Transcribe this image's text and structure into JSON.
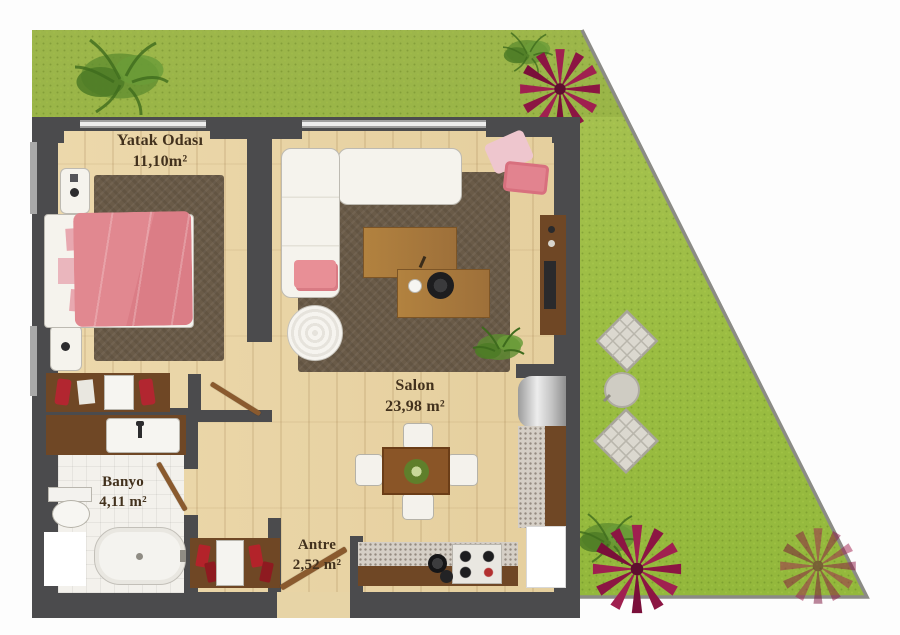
{
  "plan": {
    "rooms": [
      {
        "id": "bedroom",
        "name": "Yatak Odası",
        "area": "11,10m²"
      },
      {
        "id": "living",
        "name": "Salon",
        "area": "23,98 m²"
      },
      {
        "id": "bath",
        "name": "Banyo",
        "area": "4,11 m²"
      },
      {
        "id": "hall",
        "name": "Antre",
        "area": "2,52 m²"
      }
    ],
    "colors": {
      "grass": "#9cbd45",
      "wall": "#4b4b4d",
      "wood_floor": "#e9d5a7",
      "rug": "#6a5b48",
      "bed_accent": "#e0858c",
      "label_text": "#42311d"
    }
  }
}
